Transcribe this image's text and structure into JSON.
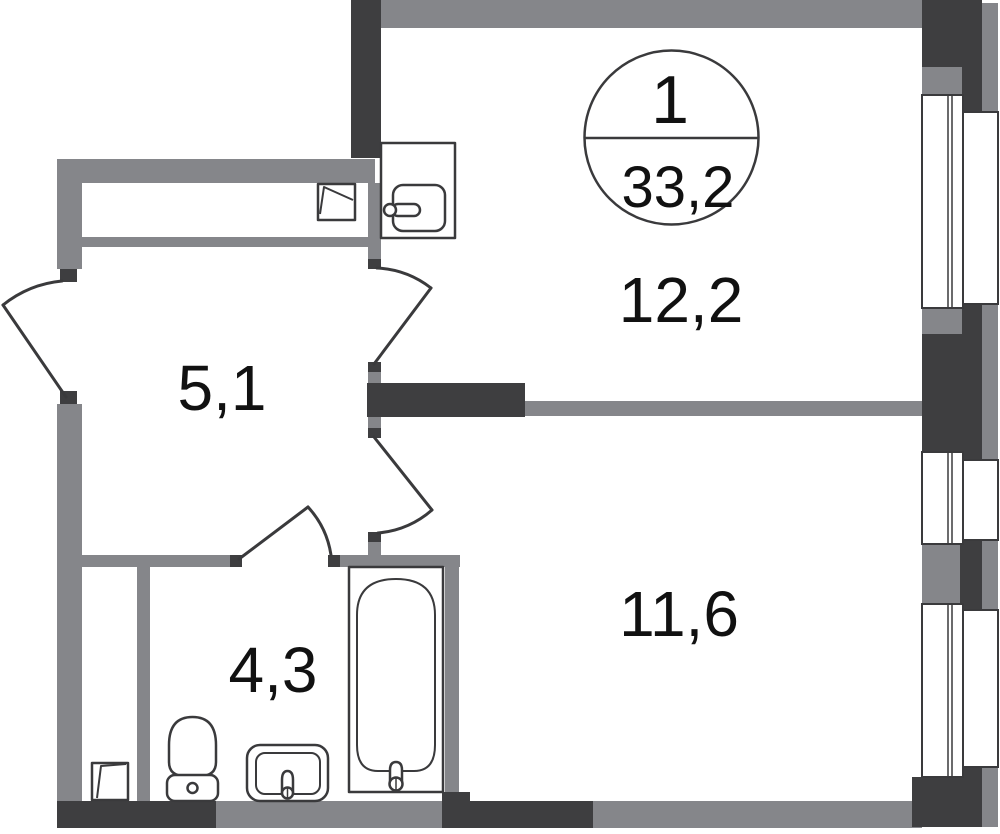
{
  "meta": {
    "title": "Apartment floor plan"
  },
  "badge": {
    "rooms_count": "1",
    "total_area": "33,2"
  },
  "room_labels": {
    "kitchen_living_room": "12,2",
    "bedroom": "11,6",
    "hallway": "5,1",
    "bathroom": "4,3"
  },
  "fixtures": {
    "kitchen_sink": "kitchen-sink-icon",
    "toilet": "toilet-icon",
    "washbasin": "washbasin-icon",
    "bathtub": "bathtub-icon",
    "vent_hatch_top": "vent-hatch-icon",
    "vent_hatch_bottom": "vent-hatch-icon"
  },
  "doors": [
    "entrance-door",
    "kitchen-living-room-door",
    "bedroom-door",
    "bathroom-door"
  ],
  "windows": [
    "window-top",
    "window-middle",
    "window-bottom"
  ],
  "colors": {
    "wall_dark": "#3e3e40",
    "wall_gray": "#85868a",
    "outline": "#3a3a3c",
    "background": "#ffffff",
    "text": "#111111"
  }
}
